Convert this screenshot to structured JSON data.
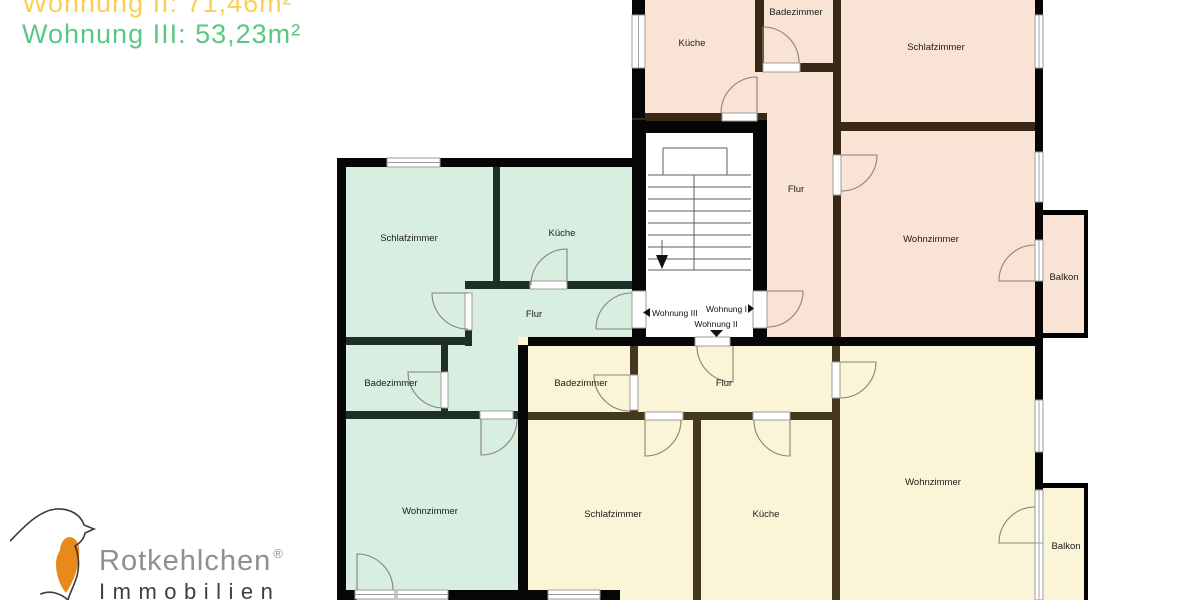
{
  "header": {
    "line1": "Wohnung II: 71,46m²",
    "line2": "Wohnung III: 53,23m²"
  },
  "apartments": {
    "wohnung1": {
      "name": "Wohnung I",
      "fill": "#f9e3d5",
      "wall": "#3a2817"
    },
    "wohnung2": {
      "name": "Wohnung II",
      "fill": "#fbf5d8",
      "wall": "#44391d"
    },
    "wohnung3": {
      "name": "Wohnung III",
      "fill": "#d8eee1",
      "wall": "#1d2f26"
    }
  },
  "rooms": {
    "w1_kueche": "Küche",
    "w1_badezimmer": "Badezimmer",
    "w1_schlafzimmer": "Schlafzimmer",
    "w1_flur": "Flur",
    "w1_wohnzimmer": "Wohnzimmer",
    "w1_balkon": "Balkon",
    "w3_schlafzimmer": "Schlafzimmer",
    "w3_kueche": "Küche",
    "w3_flur": "Flur",
    "w3_badezimmer": "Badezimmer",
    "w3_wohnzimmer": "Wohnzimmer",
    "w2_badezimmer": "Badezimmer",
    "w2_flur": "Flur",
    "w2_schlafzimmer": "Schlafzimmer",
    "w2_kueche": "Küche",
    "w2_wohnzimmer": "Wohnzimmer",
    "w2_balkon": "Balkon"
  },
  "stairwell": {
    "to_left": "Wohnung III",
    "to_right": "Wohnung I",
    "to_down": "Wohnung II"
  },
  "logo": {
    "brand": "Rotkehlchen",
    "registered": "®",
    "subtitle": "Immobilien"
  },
  "colors": {
    "header_line1": "#fbce55",
    "header_line2": "#58c884",
    "apartment1_fill": "#f9e3d5",
    "apartment2_fill": "#fbf5d8",
    "apartment3_fill": "#d8eee1",
    "logo_orange": "#e8891c",
    "logo_gray": "#8f8f8f",
    "logo_dark": "#3f3f3f"
  }
}
